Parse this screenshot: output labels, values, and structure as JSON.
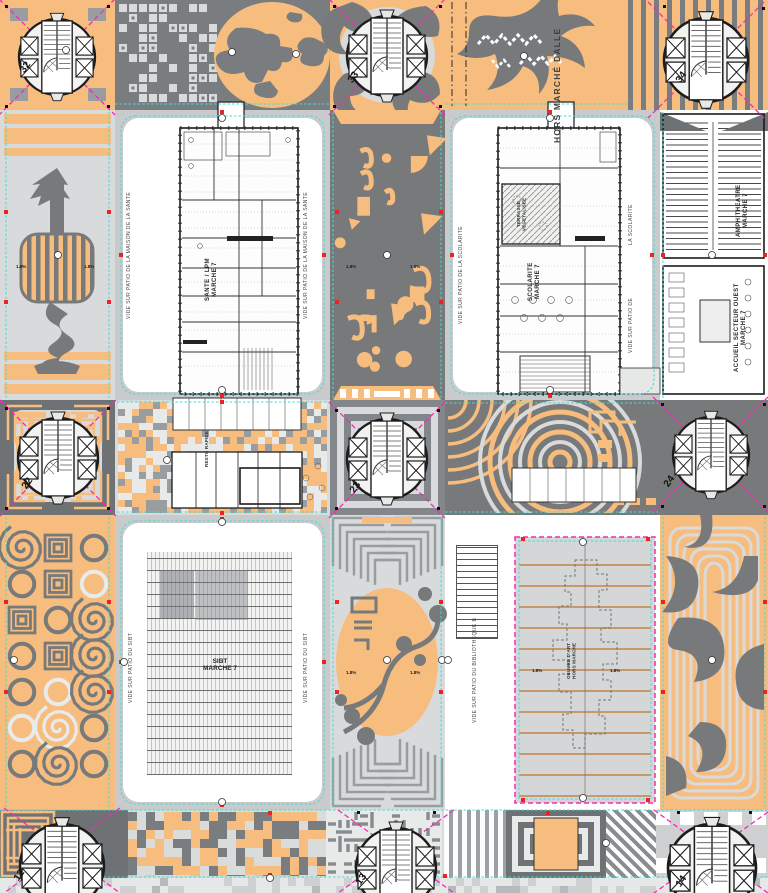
{
  "drawing": {
    "type": "architectural roof / site plan",
    "palette": {
      "orange": "#F6BD7E",
      "gray": "#797C7E",
      "gray_dark": "#6F7274",
      "light_gray": "#D9DADB",
      "white": "#FFFFFF",
      "magenta": "#F32BB4",
      "cyan": "#3BE0D6",
      "red": "#EE2222",
      "tan": "#C49A6C",
      "ink": "#1C1C1C"
    }
  },
  "towers": {
    "t32": "32",
    "t33": "33",
    "t34": "34",
    "t22": "22",
    "t23": "23",
    "t24": "24",
    "t12": "12",
    "t13": "13",
    "t14": "14"
  },
  "labels": {
    "hors_marche_dalle": "HORS MARCHÉ DALLE",
    "vide_maison_sante": "VIDE SUR PATIO DE LA MAISON DE LA SANTE",
    "sante_line1": "SANTE / LPM",
    "sante_line2": "MARCHE 7",
    "vide_scolarite": "VIDE SUR PATIO DE LA SCOLARITE",
    "la_scolarite": "LA SCOLARITE",
    "vide_sur_patio_de": "VIDE SUR PATIO DE",
    "scolarite_line1": "SCOLARITE",
    "scolarite_line2": "MARCHE 7",
    "terrasse_line1": "TERRASSE",
    "terrasse_line2": "VEGETALISEE",
    "amphi_line1": "AMPHITHEATRE",
    "amphi_line2": "MARCHE 7",
    "accueil_line1": "ACCUEIL SECTEUR OUEST",
    "accueil_line2": "MARCHE 7",
    "resto_rapide": "RESTO RAPIDE",
    "vide_sibt": "VIDE SUR PATIO DU SIBT",
    "sibt_line1": "SIBT",
    "sibt_line2": "MARCHE 7",
    "vide_bibliotheque": "VIDE SUR PATIO DU BIBLIOTHEQUE B",
    "oeuvre_line1": "OEUVRE D'ART",
    "oeuvre_line2": "HORS MARCHE",
    "slope": "1.8%"
  }
}
